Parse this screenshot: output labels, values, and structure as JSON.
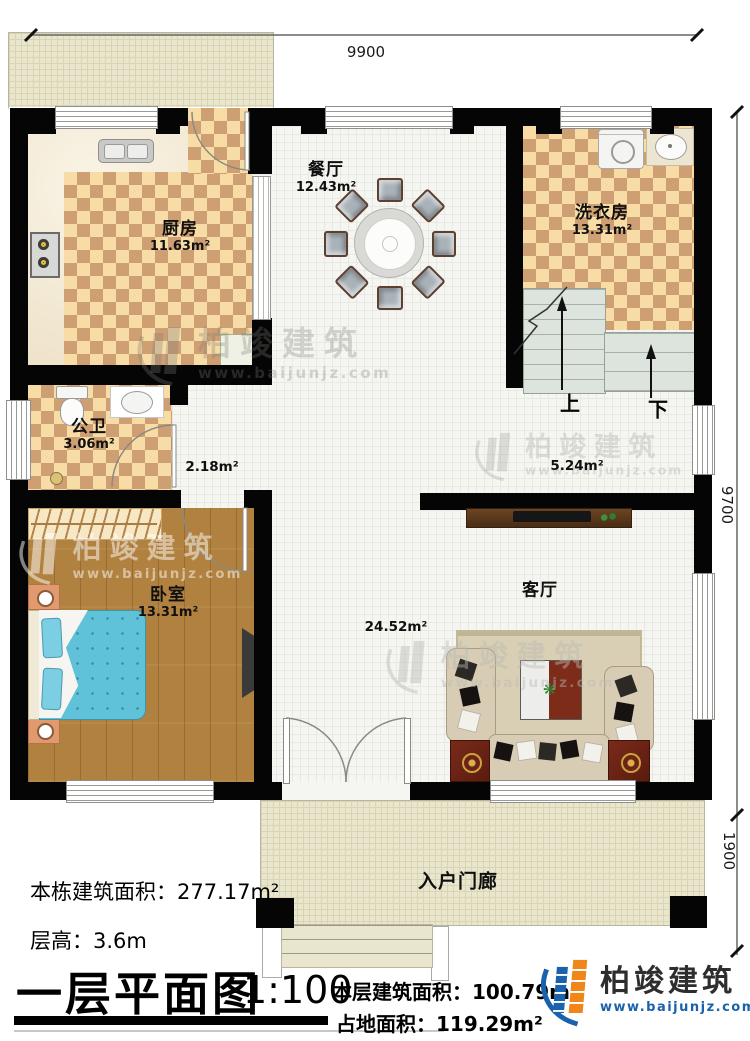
{
  "meta": {
    "title": "一层平面图",
    "scale": "1:100"
  },
  "dimensions": {
    "top": "9900",
    "side_main": "9700",
    "side_porch": "1900"
  },
  "rooms": [
    {
      "name": "厨房",
      "area": "11.63m²"
    },
    {
      "name": "餐厅",
      "area": "12.43m²"
    },
    {
      "name": "洗衣房",
      "area": "13.31m²"
    },
    {
      "name": "公卫",
      "area": "3.06m²"
    },
    {
      "name": "卧室",
      "area": "13.31m²"
    },
    {
      "name": "客厅",
      "area": "24.52m²"
    },
    {
      "name": "入户门廊",
      "area": ""
    }
  ],
  "halls": [
    {
      "area": "2.18m²"
    },
    {
      "area": "5.24m²"
    }
  ],
  "stairs": {
    "up": "上",
    "down": "下"
  },
  "info": {
    "total_label": "本栋建筑面积：",
    "total_value": "277.17m²",
    "height_label": "层高：",
    "height_value": "3.6m",
    "floor_label": "本层建筑面积：",
    "floor_value": "100.79m²",
    "land_label": "占地面积：",
    "land_value": "119.29m²"
  },
  "brand": {
    "name": "柏竣建筑",
    "url": "www.baijunjz.com",
    "blue": "#1b62ac",
    "orange": "#f08619"
  },
  "watermark": {
    "name": "柏竣建筑",
    "url": "www.baijunjz.com"
  }
}
